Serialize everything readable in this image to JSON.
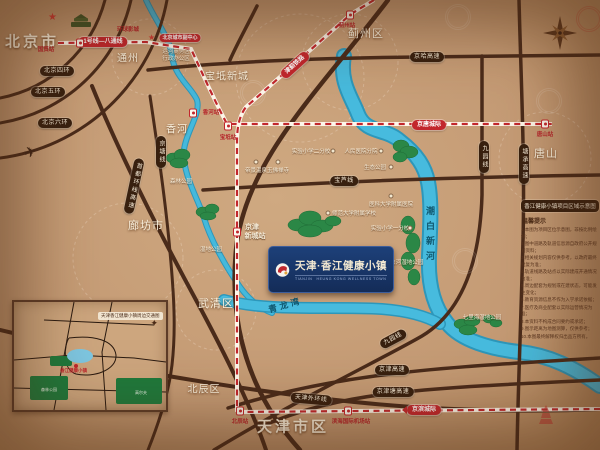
{
  "colors": {
    "background": "#c49a74",
    "road": "#4a2b1a",
    "river": "#41b7dc",
    "rail_red": "#c2272d",
    "tree": "#2b8746",
    "logo_bg": "#16335f"
  },
  "cities": [
    {
      "label": "北京市"
    },
    {
      "label": "通州"
    },
    {
      "label": "香河"
    },
    {
      "label": "蓟州区"
    },
    {
      "label": "宝坻新城"
    },
    {
      "label": "廊坊市"
    },
    {
      "label": "武清区"
    },
    {
      "label": "北辰区"
    },
    {
      "label": "天津市区"
    },
    {
      "label": "唐山"
    }
  ],
  "roads": [
    {
      "label": "北京四环"
    },
    {
      "label": "北京五环"
    },
    {
      "label": "北京六环"
    },
    {
      "label": "首都环线高速"
    },
    {
      "label": "京塘线"
    },
    {
      "label": "京哈高速"
    },
    {
      "label": "宝芦线"
    },
    {
      "label": "九园线"
    },
    {
      "label": "塘承高速"
    },
    {
      "label": "九园线"
    },
    {
      "label": "京津高速"
    },
    {
      "label": "京津塘高速"
    },
    {
      "label": "天津外环线"
    }
  ],
  "rails": [
    {
      "label": "1号线—八通线"
    },
    {
      "label": "津蓟铁路"
    },
    {
      "label": "京唐城际"
    },
    {
      "label": "京滨城际"
    }
  ],
  "stations": {
    "guomao": "国贸站",
    "universal": "环球影城",
    "subcenter": "北京城市副中心",
    "canal1": "运河商务区",
    "canal2": "行政办公区",
    "xianghe": "香河站",
    "baodi": "宝坻站",
    "jizhou": "蓟州站",
    "tangshan": "唐山站",
    "jjxc1": "京津",
    "jjxc2": "新城站",
    "beichen": "北辰站",
    "airport": "滨海国际机场站"
  },
  "rivers": {
    "qinglongwan": "青龙湾",
    "chaobai": "潮白新河"
  },
  "parks": {
    "p1": "森林公园",
    "p2": "湿地公园",
    "p3": "潮白河湿地公园",
    "p4": "七里海湿地公园"
  },
  "amenities": [
    {
      "label": "帝景温泉"
    },
    {
      "label": "玉佛禅寺"
    },
    {
      "label": "实验小学二分校"
    },
    {
      "label": "人民医院分院"
    },
    {
      "label": "生态公园"
    },
    {
      "label": "医科大学附属医院"
    },
    {
      "label": "师范大学附属学校"
    },
    {
      "label": "实验小学一分校"
    }
  ],
  "logo": {
    "zh": "天津·香江健康小镇",
    "en1": "TIANJIN",
    "en2": "HEUNG KONG WELLNESS TOWN"
  },
  "panel": {
    "title": "香江健康小镇项目区域示意图",
    "tip": "温馨提示",
    "notes": [
      "1.本图为项目区位示意图，非按比例绘制；",
      "2.图中道路及轨道信息源自政府公开规划资料；",
      "3.相关规划内容仅供参考，以政府最终批复为准；",
      "4.轨道线路及站点以实际建成开通情况为准；",
      "5.周边配套为规划或在建状态，可能发生变化；",
      "6.教育资源信息不作为入学承诺依据；",
      "7.医疗及商业配套以实际运营情况为准；",
      "8.本资料不构成合同要约或承诺；",
      "9.图示距离为地图测算，仅供参考；",
      "10.本图最终解释权归出品方所有。"
    ]
  },
  "inset": {
    "title": "天津香江健康小镇周边交通图",
    "marker": "香江健康小镇",
    "g1": "森林公园",
    "g2": "高尔夫"
  }
}
